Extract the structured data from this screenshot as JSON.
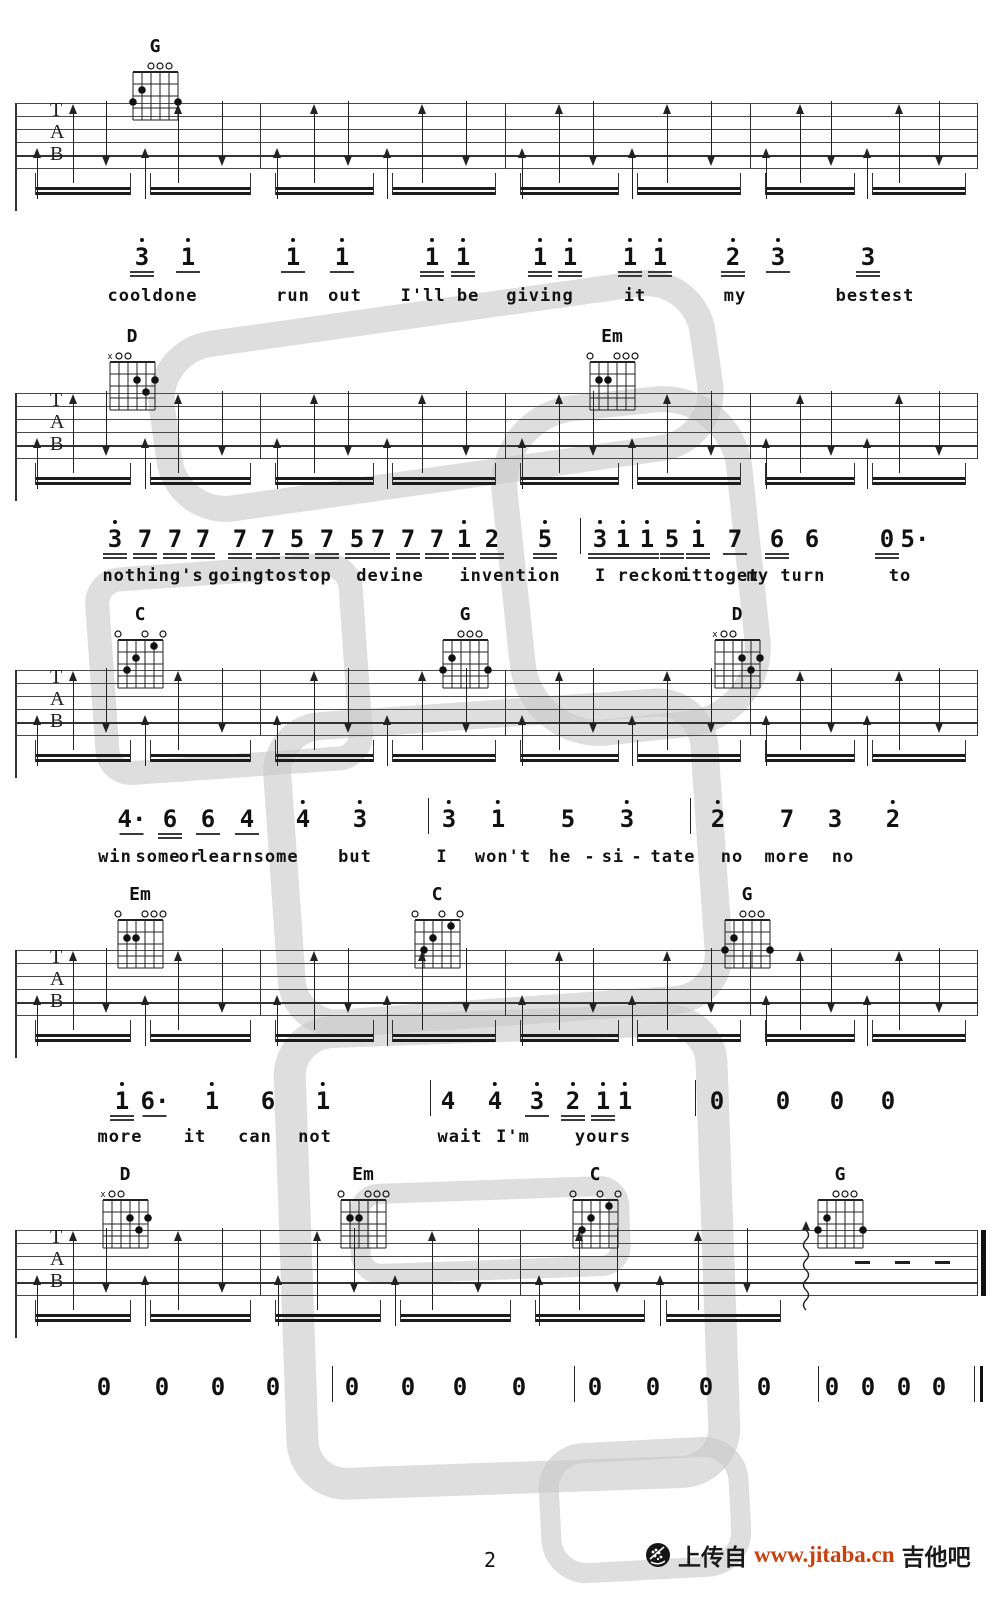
{
  "page": {
    "number": "2"
  },
  "footer": {
    "upload_text": "上传自",
    "site_url": "www.jitaba.cn",
    "site_name": "吉他吧",
    "url_color": "#c8410e",
    "logo_icon": "guitar-soundhole-icon"
  },
  "clef_letters": [
    "T",
    "A",
    "B"
  ],
  "ink_color": "#1a1a1a",
  "watermark_color": "#c9c9c9",
  "chord_shapes": {
    "G": {
      "markers": [
        "",
        "",
        "o",
        "o",
        "o",
        ""
      ],
      "dots": [
        [
          2,
          2
        ],
        [
          1,
          3
        ],
        [
          6,
          3
        ]
      ]
    },
    "D": {
      "markers": [
        "x",
        "o",
        "o",
        "",
        "",
        ""
      ],
      "dots": [
        [
          4,
          2
        ],
        [
          6,
          2
        ],
        [
          5,
          3
        ]
      ]
    },
    "Em": {
      "markers": [
        "o",
        "",
        "",
        "o",
        "o",
        "o"
      ],
      "dots": [
        [
          2,
          2
        ],
        [
          3,
          2
        ]
      ]
    },
    "C": {
      "markers": [
        "o",
        "",
        "",
        "o",
        "",
        "o"
      ],
      "dots": [
        [
          5,
          1
        ],
        [
          3,
          2
        ],
        [
          2,
          3
        ]
      ]
    }
  },
  "systems": [
    {
      "id": "system-1",
      "chord_top": 38,
      "staff_top": 103,
      "chords": [
        {
          "name": "G",
          "x": 15.5
        }
      ],
      "measures": [
        [
          2,
          26
        ],
        [
          26,
          50.5
        ],
        [
          50.5,
          75
        ],
        [
          75,
          97.5
        ]
      ],
      "ending": null
    },
    {
      "id": "system-2",
      "chord_top": 328,
      "staff_top": 393,
      "chords": [
        {
          "name": "D",
          "x": 13.2
        },
        {
          "name": "Em",
          "x": 61.2
        }
      ],
      "measures": [
        [
          2,
          26
        ],
        [
          26,
          50.5
        ],
        [
          50.5,
          75
        ],
        [
          75,
          97.5
        ]
      ],
      "ending": null
    },
    {
      "id": "system-3",
      "chord_top": 606,
      "staff_top": 670,
      "chords": [
        {
          "name": "C",
          "x": 14
        },
        {
          "name": "G",
          "x": 46.5
        },
        {
          "name": "D",
          "x": 73.7
        }
      ],
      "measures": [
        [
          2,
          26
        ],
        [
          26,
          50.5
        ],
        [
          50.5,
          75
        ],
        [
          75,
          97.5
        ]
      ],
      "ending": null
    },
    {
      "id": "system-4",
      "chord_top": 886,
      "staff_top": 950,
      "chords": [
        {
          "name": "Em",
          "x": 14
        },
        {
          "name": "C",
          "x": 43.7
        },
        {
          "name": "G",
          "x": 74.7
        }
      ],
      "measures": [
        [
          2,
          26
        ],
        [
          26,
          50.5
        ],
        [
          50.5,
          75
        ],
        [
          75,
          97.5
        ]
      ],
      "ending": null
    },
    {
      "id": "system-5",
      "chord_top": 1166,
      "staff_top": 1230,
      "chords": [
        {
          "name": "D",
          "x": 12.5
        },
        {
          "name": "Em",
          "x": 36.3
        },
        {
          "name": "C",
          "x": 59.5
        },
        {
          "name": "G",
          "x": 84
        }
      ],
      "measures": [
        [
          2,
          26
        ],
        [
          26,
          52
        ],
        [
          52,
          79
        ]
      ],
      "ending": {
        "squiggle_x": 80.5,
        "dashes_x": [
          85.5,
          89.5,
          93.5
        ],
        "final_bar_x": 97.7
      }
    }
  ],
  "melody_lines": [
    {
      "top": 238,
      "lyrics_top": 286,
      "tokens": [
        {
          "t": "3",
          "d": 1,
          "u": 2,
          "x": 14.2
        },
        {
          "t": "1",
          "d": 1,
          "u": 1,
          "x": 18.8
        },
        {
          "t": "1",
          "d": 1,
          "u": 1,
          "x": 29.3
        },
        {
          "t": "1",
          "d": 1,
          "u": 1,
          "x": 34.2
        },
        {
          "t": "1",
          "d": 1,
          "u": 2,
          "x": 43.2
        },
        {
          "t": "1",
          "d": 1,
          "u": 2,
          "x": 46.3
        },
        {
          "t": "1",
          "d": 1,
          "u": 2,
          "x": 54
        },
        {
          "t": "1",
          "d": 1,
          "u": 2,
          "x": 57
        },
        {
          "t": "1",
          "d": 1,
          "u": 2,
          "x": 63
        },
        {
          "t": "1",
          "d": 1,
          "u": 2,
          "x": 66
        },
        {
          "t": "2",
          "d": 1,
          "u": 2,
          "x": 73.3
        },
        {
          "t": "3",
          "d": 1,
          "u": 1,
          "x": 77.8
        },
        {
          "t": "3",
          "d": 0,
          "u": 2,
          "x": 86.8
        }
      ],
      "lyrics": [
        {
          "t": "cool",
          "x": 13
        },
        {
          "t": "done",
          "x": 17.5
        },
        {
          "t": "run",
          "x": 29.3
        },
        {
          "t": "out",
          "x": 34.5
        },
        {
          "t": "I'll be",
          "x": 44
        },
        {
          "t": "giving",
          "x": 54
        },
        {
          "t": "it",
          "x": 63.5
        },
        {
          "t": "my",
          "x": 73.5
        },
        {
          "t": "bestest",
          "x": 87.5
        }
      ]
    },
    {
      "top": 520,
      "lyrics_top": 566,
      "tokens": [
        {
          "t": "3",
          "d": 1,
          "u": 2,
          "x": 11.5
        },
        {
          "t": "7",
          "d": 0,
          "u": 2,
          "x": 14.5
        },
        {
          "t": "7",
          "d": 0,
          "u": 2,
          "x": 17.5
        },
        {
          "t": "7",
          "d": 0,
          "u": 2,
          "x": 20.3
        },
        {
          "t": "7",
          "d": 0,
          "u": 2,
          "x": 24
        },
        {
          "t": "7",
          "d": 0,
          "u": 2,
          "x": 26.8
        },
        {
          "t": "5",
          "d": 0,
          "u": 2,
          "x": 29.7
        },
        {
          "t": "7",
          "d": 0,
          "u": 2,
          "x": 32.7
        },
        {
          "t": "5",
          "d": 0,
          "u": 2,
          "x": 35.7
        },
        {
          "t": "7",
          "d": 0,
          "u": 2,
          "x": 37.8
        },
        {
          "t": "7",
          "d": 0,
          "u": 2,
          "x": 40.8
        },
        {
          "t": "7",
          "d": 0,
          "u": 2,
          "x": 43.7
        },
        {
          "t": "1",
          "d": 1,
          "u": 2,
          "x": 46.4
        },
        {
          "t": "2",
          "d": 0,
          "u": 2,
          "x": 49.2
        },
        {
          "t": "5",
          "d": 1,
          "u": 2,
          "x": 54.5
        },
        {
          "t": "|",
          "bar": 1,
          "x": 58
        },
        {
          "t": "3",
          "d": 1,
          "u": 2,
          "x": 60
        },
        {
          "t": "1",
          "d": 1,
          "u": 2,
          "x": 62.3
        },
        {
          "t": "1",
          "d": 1,
          "u": 2,
          "x": 64.7
        },
        {
          "t": "5",
          "d": 0,
          "u": 2,
          "x": 67.2
        },
        {
          "t": "1",
          "d": 1,
          "u": 2,
          "x": 69.8
        },
        {
          "t": "7",
          "d": 0,
          "u": 1,
          "x": 73.5
        },
        {
          "t": "6",
          "d": 0,
          "u": 2,
          "x": 77.7
        },
        {
          "t": "6",
          "d": 0,
          "u": 0,
          "x": 81.2
        },
        {
          "t": "0",
          "d": 0,
          "u": 2,
          "x": 88.7
        },
        {
          "t": "5·",
          "d": 0,
          "u": 0,
          "x": 91.5
        }
      ],
      "lyrics": [
        {
          "t": "nothing's",
          "x": 15.3
        },
        {
          "t": "goingtostop",
          "x": 27
        },
        {
          "t": "devine",
          "x": 39
        },
        {
          "t": "invention",
          "x": 51
        },
        {
          "t": "I reckon",
          "x": 64
        },
        {
          "t": "ittoget",
          "x": 72
        },
        {
          "t": "my turn",
          "x": 78.6
        },
        {
          "t": "to",
          "x": 90
        }
      ]
    },
    {
      "top": 800,
      "lyrics_top": 847,
      "tokens": [
        {
          "t": "4·",
          "d": 0,
          "u": 1,
          "x": 13.2
        },
        {
          "t": "6",
          "d": 0,
          "u": 2,
          "x": 17
        },
        {
          "t": "6",
          "d": 0,
          "u": 1,
          "x": 20.8
        },
        {
          "t": "4",
          "d": 0,
          "u": 1,
          "x": 24.7
        },
        {
          "t": "4",
          "d": 1,
          "u": 0,
          "x": 30.3
        },
        {
          "t": "3",
          "d": 1,
          "u": 0,
          "x": 36
        },
        {
          "t": "|",
          "bar": 1,
          "x": 42.8
        },
        {
          "t": "3",
          "d": 1,
          "u": 0,
          "x": 44.9
        },
        {
          "t": "1",
          "d": 1,
          "u": 0,
          "x": 49.8
        },
        {
          "t": "5",
          "d": 0,
          "u": 0,
          "x": 56.8
        },
        {
          "t": "3",
          "d": 1,
          "u": 0,
          "x": 62.7
        },
        {
          "t": "|",
          "bar": 1,
          "x": 69
        },
        {
          "t": "2",
          "d": 1,
          "u": 0,
          "x": 71.8
        },
        {
          "t": "7",
          "d": 0,
          "u": 0,
          "x": 78.7
        },
        {
          "t": "3",
          "d": 0,
          "u": 0,
          "x": 83.5
        },
        {
          "t": "2",
          "d": 1,
          "u": 0,
          "x": 89.3
        }
      ],
      "lyrics": [
        {
          "t": "win",
          "x": 11.5
        },
        {
          "t": "some",
          "x": 15.8
        },
        {
          "t": "or",
          "x": 19
        },
        {
          "t": "learnsome",
          "x": 24.8
        },
        {
          "t": "but",
          "x": 35.5
        },
        {
          "t": "I",
          "x": 44.2
        },
        {
          "t": "won't",
          "x": 50.3
        },
        {
          "t": "he",
          "x": 56
        },
        {
          "t": "-",
          "x": 59
        },
        {
          "t": "si",
          "x": 61.3
        },
        {
          "t": "-",
          "x": 63.7
        },
        {
          "t": "tate",
          "x": 67.3
        },
        {
          "t": "no",
          "x": 73.2
        },
        {
          "t": "more",
          "x": 78.7
        },
        {
          "t": "no",
          "x": 84.3
        }
      ]
    },
    {
      "top": 1082,
      "lyrics_top": 1127,
      "tokens": [
        {
          "t": "1",
          "d": 1,
          "u": 2,
          "x": 12.2
        },
        {
          "t": "6·",
          "d": 0,
          "u": 1,
          "x": 15.5
        },
        {
          "t": "1",
          "d": 1,
          "u": 0,
          "x": 21.2
        },
        {
          "t": "6",
          "d": 0,
          "u": 0,
          "x": 26.8
        },
        {
          "t": "1",
          "d": 1,
          "u": 0,
          "x": 32.3
        },
        {
          "t": "|",
          "bar": 1,
          "x": 43
        },
        {
          "t": "4",
          "d": 0,
          "u": 0,
          "x": 44.8
        },
        {
          "t": "4",
          "d": 1,
          "u": 0,
          "x": 49.5
        },
        {
          "t": "3",
          "d": 1,
          "u": 1,
          "x": 53.7
        },
        {
          "t": "2",
          "d": 1,
          "u": 2,
          "x": 57.3
        },
        {
          "t": "1",
          "d": 1,
          "u": 2,
          "x": 60.3
        },
        {
          "t": "1",
          "d": 1,
          "u": 0,
          "x": 62.5
        },
        {
          "t": "|",
          "bar": 1,
          "x": 69.5
        },
        {
          "t": "0",
          "d": 0,
          "u": 0,
          "x": 71.7
        },
        {
          "t": "0",
          "d": 0,
          "u": 0,
          "x": 78.3
        },
        {
          "t": "0",
          "d": 0,
          "u": 0,
          "x": 83.7
        },
        {
          "t": "0",
          "d": 0,
          "u": 0,
          "x": 88.8
        }
      ],
      "lyrics": [
        {
          "t": "more",
          "x": 12
        },
        {
          "t": "it",
          "x": 19.5
        },
        {
          "t": "can",
          "x": 25.5
        },
        {
          "t": "not",
          "x": 31.5
        },
        {
          "t": "wait",
          "x": 46
        },
        {
          "t": "I'm",
          "x": 51.3
        },
        {
          "t": "yours",
          "x": 60.3
        }
      ]
    },
    {
      "top": 1368,
      "lyrics_top": null,
      "tokens": [
        {
          "t": "0",
          "d": 0,
          "u": 0,
          "x": 10.4
        },
        {
          "t": "0",
          "d": 0,
          "u": 0,
          "x": 16.2
        },
        {
          "t": "0",
          "d": 0,
          "u": 0,
          "x": 21.8
        },
        {
          "t": "0",
          "d": 0,
          "u": 0,
          "x": 27.3
        },
        {
          "t": "|",
          "bar": 1,
          "x": 33.2
        },
        {
          "t": "0",
          "d": 0,
          "u": 0,
          "x": 35.2
        },
        {
          "t": "0",
          "d": 0,
          "u": 0,
          "x": 40.8
        },
        {
          "t": "0",
          "d": 0,
          "u": 0,
          "x": 46
        },
        {
          "t": "0",
          "d": 0,
          "u": 0,
          "x": 51.9
        },
        {
          "t": "|",
          "bar": 1,
          "x": 57.4
        },
        {
          "t": "0",
          "d": 0,
          "u": 0,
          "x": 59.5
        },
        {
          "t": "0",
          "d": 0,
          "u": 0,
          "x": 65.3
        },
        {
          "t": "0",
          "d": 0,
          "u": 0,
          "x": 70.6
        },
        {
          "t": "0",
          "d": 0,
          "u": 0,
          "x": 76.4
        },
        {
          "t": "|",
          "bar": 1,
          "x": 81.8
        },
        {
          "t": "0",
          "d": 0,
          "u": 0,
          "x": 83.2
        },
        {
          "t": "0",
          "d": 0,
          "u": 0,
          "x": 86.8
        },
        {
          "t": "0",
          "d": 0,
          "u": 0,
          "x": 90.4
        },
        {
          "t": "0",
          "d": 0,
          "u": 0,
          "x": 93.9
        },
        {
          "t": "‖",
          "finalbar": 1,
          "x": 97.4
        }
      ],
      "lyrics": []
    }
  ],
  "strum_pattern": [
    {
      "p": 0.07,
      "type": "up-short"
    },
    {
      "p": 0.22,
      "type": "up-tall"
    },
    {
      "p": 0.36,
      "type": "down"
    },
    {
      "p": 0.52,
      "type": "up-short"
    },
    {
      "p": 0.66,
      "type": "up-tall"
    },
    {
      "p": 0.84,
      "type": "down"
    }
  ]
}
